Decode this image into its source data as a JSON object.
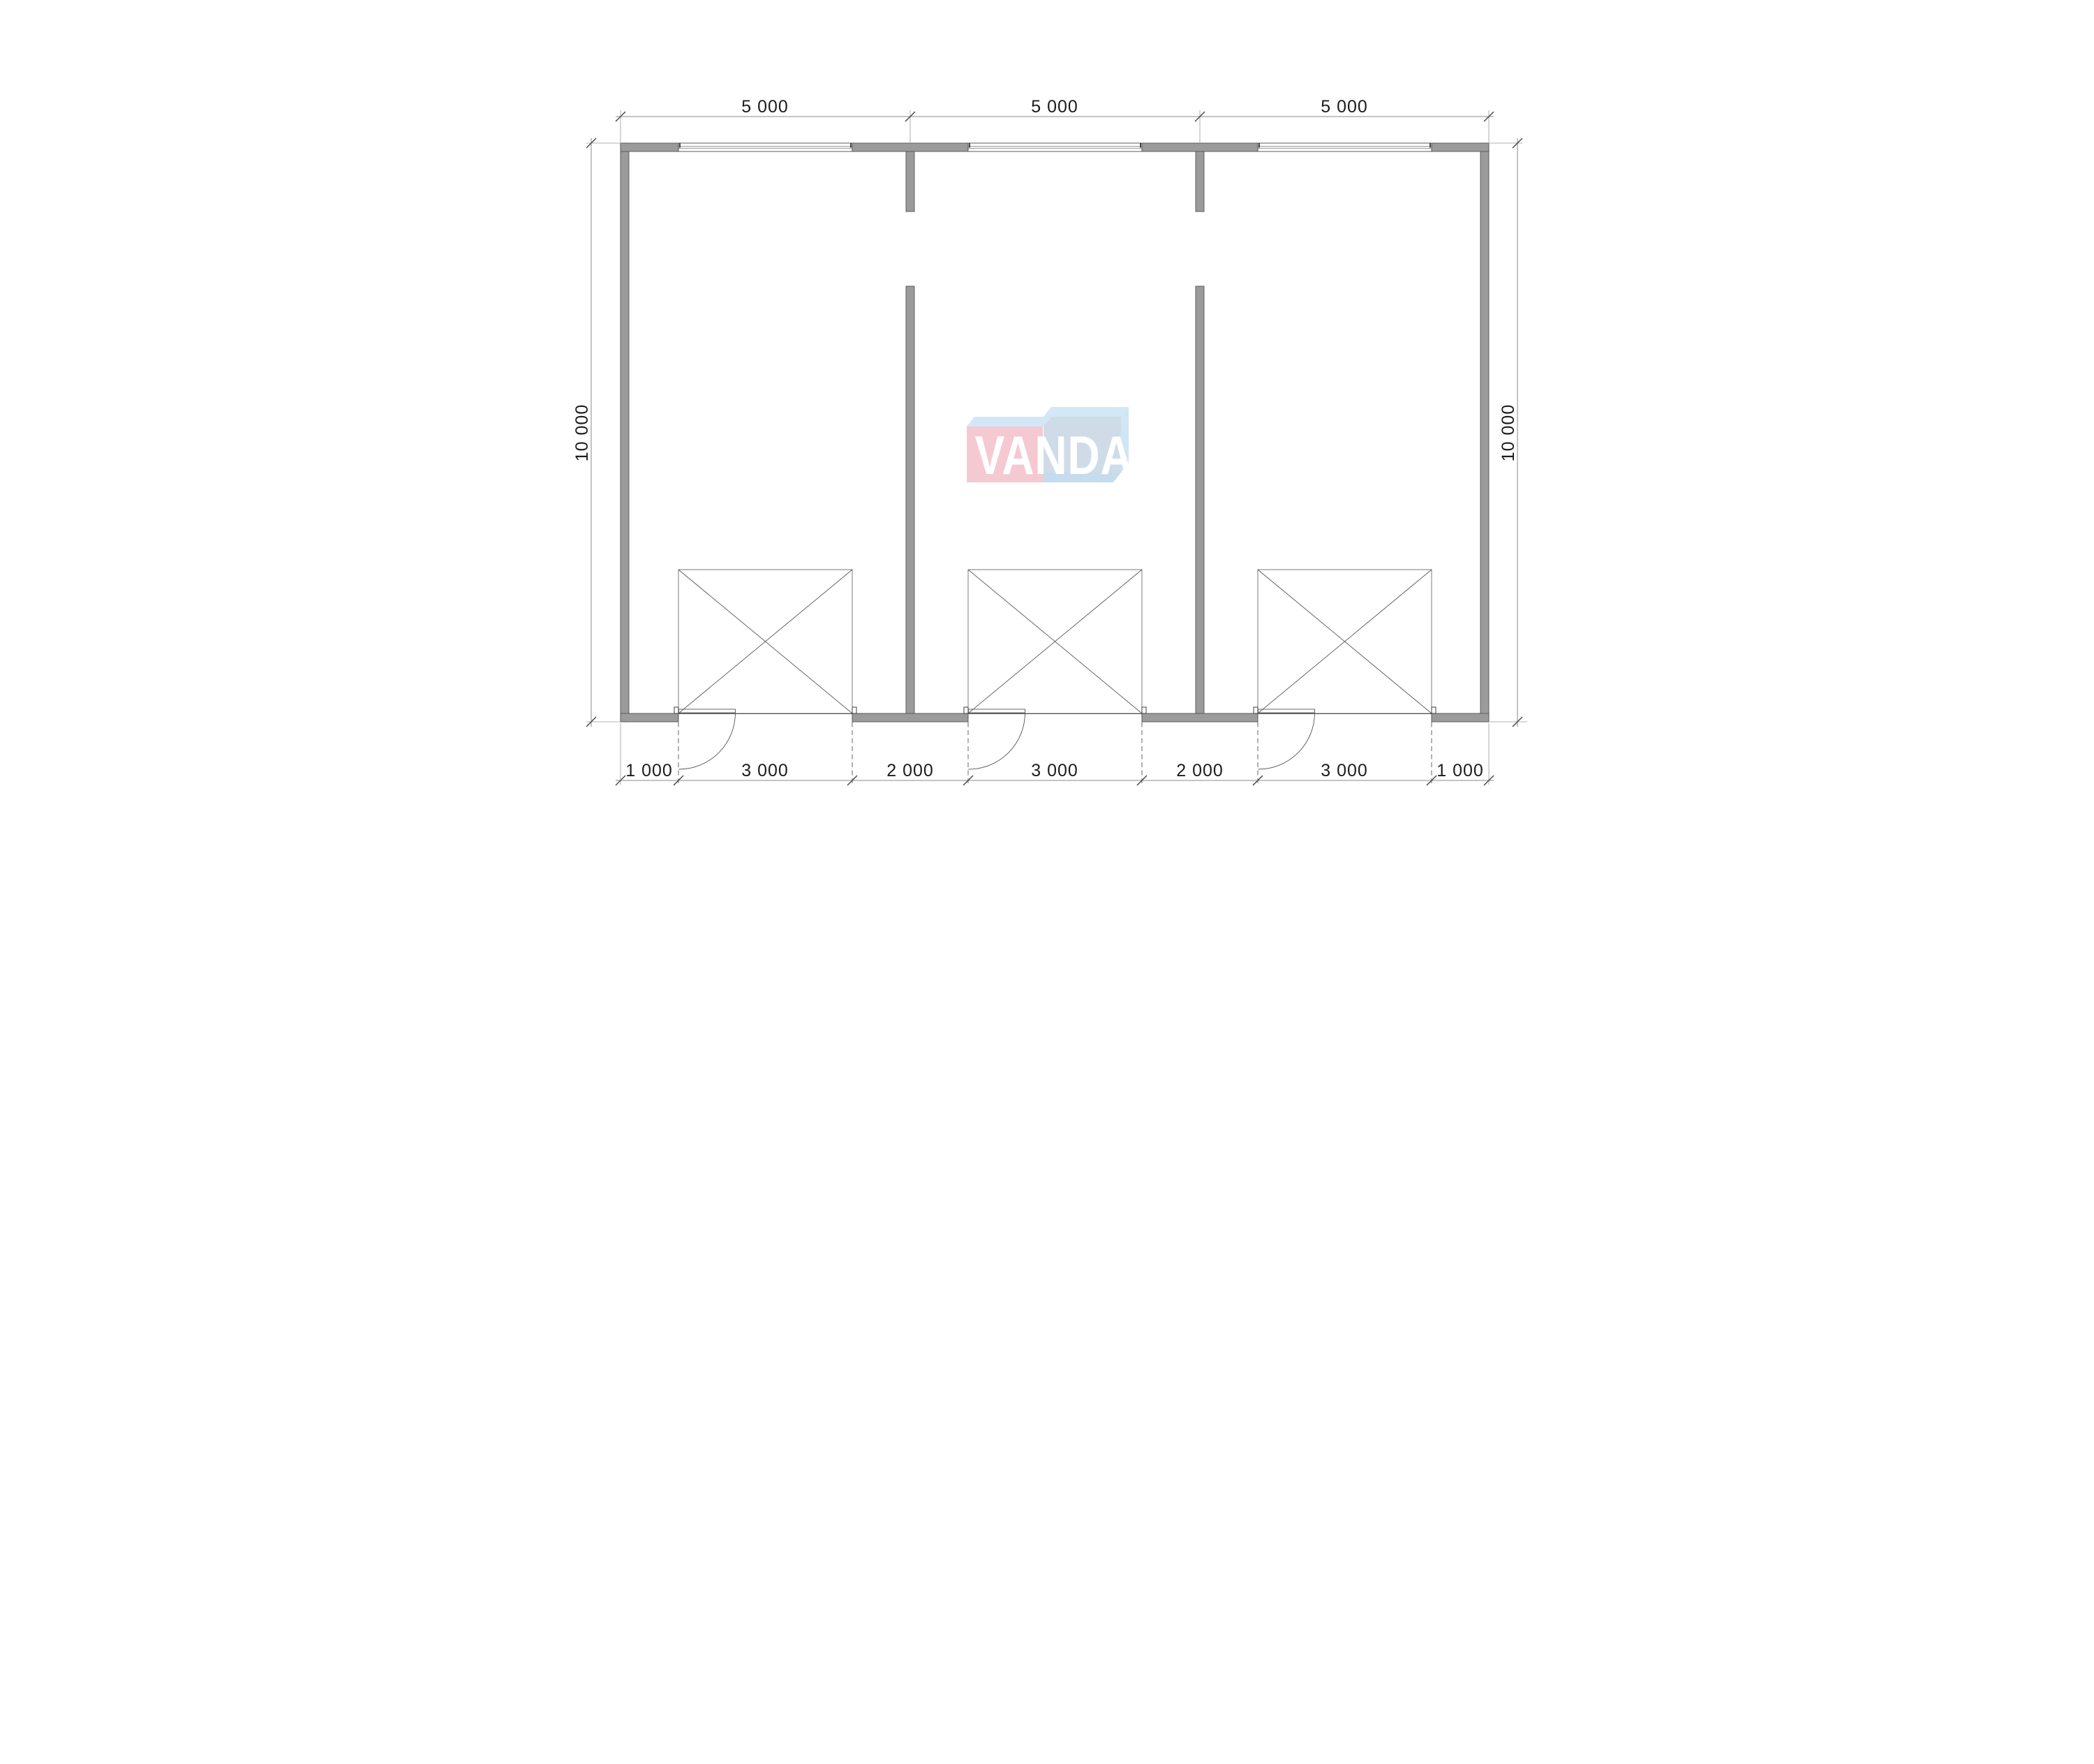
{
  "drawing": {
    "top_dimensions": [
      "5 000",
      "5 000",
      "5 000"
    ],
    "bottom_dimensions": [
      "1 000",
      "3 000",
      "2 000",
      "3 000",
      "2 000",
      "3 000",
      "1 000"
    ],
    "left_dimension": "10 000",
    "right_dimension": "10 000"
  },
  "watermark": {
    "text": "VANDA",
    "pink_face_color": "#f5c9d2",
    "blue_face_color": "#cfdce8",
    "light_blue_top_color": "#d3e7f6",
    "letter_color": "#ffffff"
  },
  "colors": {
    "background": "#ffffff",
    "wall_fill": "#9b9b9b",
    "line": "#555555",
    "dimension_line": "#8a8a8a",
    "dimension_text": "#1c1c1c"
  }
}
